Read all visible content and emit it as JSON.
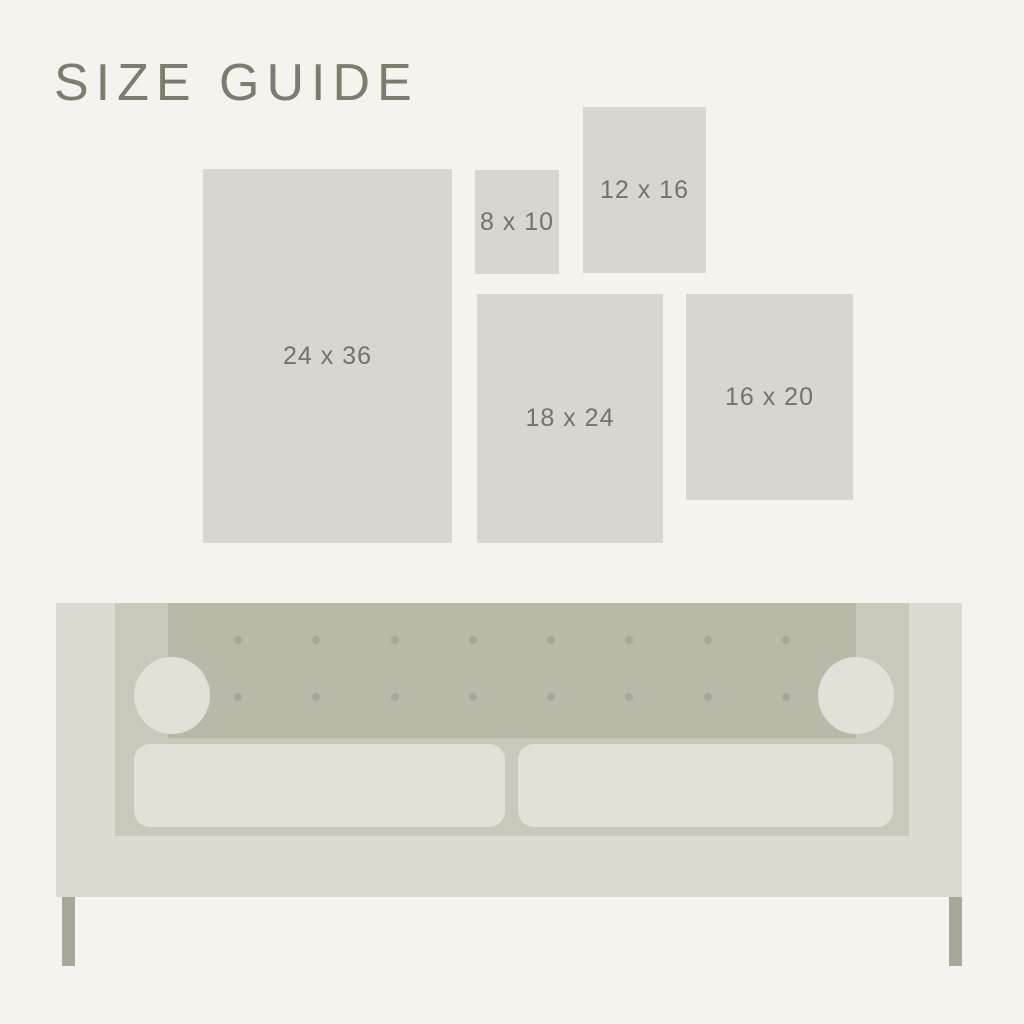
{
  "title": "SIZE GUIDE",
  "sizes": [
    {
      "id": "24x36",
      "label": "24 x 36"
    },
    {
      "id": "8x10",
      "label": "8 x 10"
    },
    {
      "id": "12x16",
      "label": "12 x 16"
    },
    {
      "id": "18x24",
      "label": "18 x 24"
    },
    {
      "id": "16x20",
      "label": "16 x 20"
    }
  ],
  "sofa": {
    "tufting": {
      "rows": 2,
      "cols": 8
    }
  },
  "colors": {
    "background": "#f4f3ee",
    "swatch_fill": "#d8d7cf",
    "title_text": "#7d7d6f",
    "label_text": "#73736a",
    "sofa_body": "#dcdbd1",
    "sofa_inner_frame": "#c9c8bb",
    "sofa_back_cushion": "#b9b8a9",
    "cushion_and_bolster": "#e1e1d7",
    "tufting_button": "#a6a699",
    "sofa_leg": "#a8a79a"
  }
}
